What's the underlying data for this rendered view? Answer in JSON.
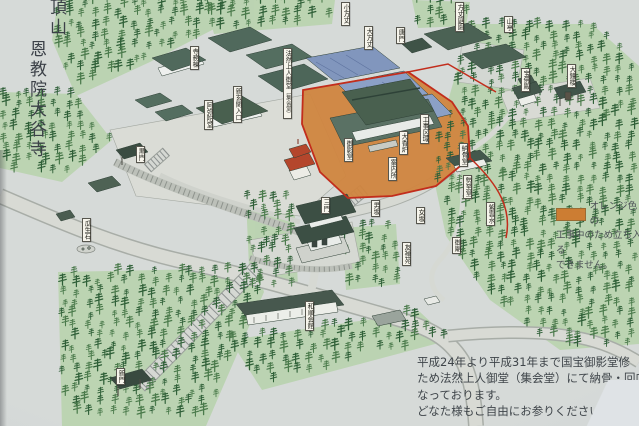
{
  "title": {
    "line1": "頂山",
    "line2": "恩教院大谷寺"
  },
  "legend": {
    "swatch_color": "#cc7d33",
    "line1": "オレンジ色の",
    "line2": "工事中のため立ち入る",
    "line3": "できません。"
  },
  "notice": {
    "lines": [
      "平成24年より平成31年まで国宝御影堂修",
      "ため法然上人御堂（集会堂）にて納骨・回向を",
      "なっております。",
      "どなた様もご自由にお参りください。"
    ]
  },
  "map": {
    "labels": [
      {
        "id": "temple-office",
        "text": "寺務棟",
        "x": 190,
        "y": 46
      },
      {
        "id": "amidado",
        "text": "阿弥陀堂",
        "x": 204,
        "y": 100
      },
      {
        "id": "new-entrance",
        "text": "新玄関入口",
        "x": 233,
        "y": 86
      },
      {
        "id": "honen-hall",
        "text": "法然上人御堂",
        "sub": "（集会堂）",
        "x": 283,
        "y": 48
      },
      {
        "id": "kohojo",
        "text": "小方丈",
        "x": 341,
        "y": 2
      },
      {
        "id": "ohojo",
        "text": "大方丈",
        "x": 364,
        "y": 26
      },
      {
        "id": "karamon",
        "text": "唐門",
        "x": 396,
        "y": 27
      },
      {
        "id": "hojo-garden",
        "text": "方丈庭園",
        "x": 455,
        "y": 2
      },
      {
        "id": "santei",
        "text": "山亭",
        "x": 504,
        "y": 16
      },
      {
        "id": "miedo",
        "text": "御影堂",
        "x": 344,
        "y": 138
      },
      {
        "id": "construction-zone",
        "text": "工事区域",
        "x": 420,
        "y": 114
      },
      {
        "id": "incense-burner",
        "text": "大香炉",
        "x": 399,
        "y": 131
      },
      {
        "id": "information",
        "text": "案内所",
        "x": 388,
        "y": 157
      },
      {
        "id": "nokotsudo",
        "text": "納骨堂",
        "x": 459,
        "y": 143
      },
      {
        "id": "hobutsuden",
        "text": "宝佛殿",
        "x": 521,
        "y": 68
      },
      {
        "id": "great-bell",
        "text": "大鐘楼",
        "x": 567,
        "y": 64
      },
      {
        "id": "seishido",
        "text": "勢至堂",
        "x": 463,
        "y": 175
      },
      {
        "id": "shiunsui",
        "text": "紫雲水",
        "x": 486,
        "y": 202
      },
      {
        "id": "mausoleum",
        "text": "御廟",
        "x": 452,
        "y": 237
      },
      {
        "id": "sanmon",
        "text": "三門",
        "x": 321,
        "y": 197
      },
      {
        "id": "otokozaka",
        "text": "男坂",
        "x": 371,
        "y": 200
      },
      {
        "id": "onnazaka",
        "text": "女坂",
        "x": 416,
        "y": 207
      },
      {
        "id": "yuzen-garden",
        "text": "友禅苑",
        "x": 402,
        "y": 242
      },
      {
        "id": "uryuseki",
        "text": "瓜生石",
        "x": 82,
        "y": 218
      },
      {
        "id": "kuromon",
        "text": "黒門",
        "x": 136,
        "y": 146
      },
      {
        "id": "shinmon",
        "text": "新門",
        "x": 116,
        "y": 368
      },
      {
        "id": "wajun-hall",
        "text": "和順会館",
        "x": 305,
        "y": 301
      }
    ]
  },
  "colors": {
    "construction_orange": "#d0853f",
    "route_red": "#c22d1c",
    "forest_green": "#b9d3ae",
    "roof_dark": "#49604f",
    "roof_blue": "#8196bd",
    "vermillion": "#b4462c"
  }
}
